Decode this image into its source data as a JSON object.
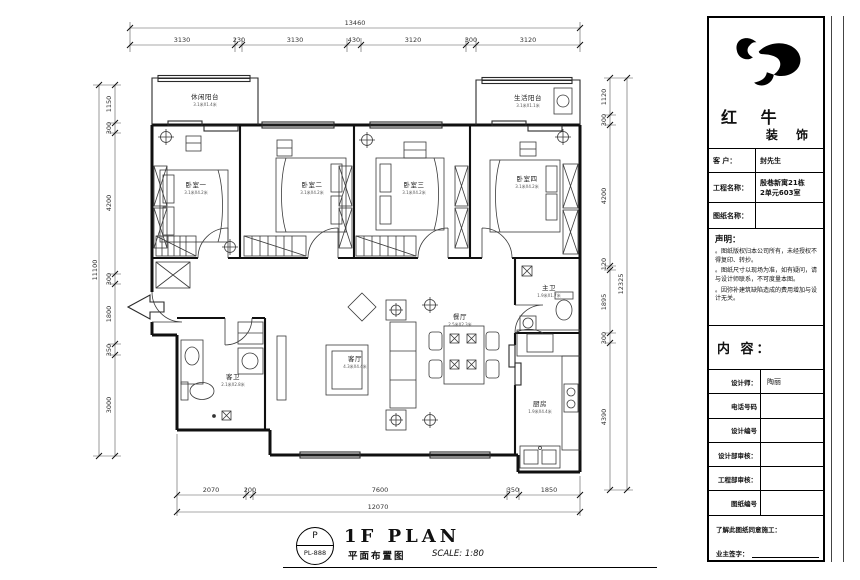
{
  "title_block": {
    "company_name_top": "红 牛",
    "company_name_bottom": "装 饰",
    "client_label": "客 户：",
    "client_value": "封先生",
    "project_label": "工程名称：",
    "project_value_line1": "殷巷新寓21栋",
    "project_value_line2": "2单元603室",
    "drawing_name_label": "图纸名称：",
    "drawing_name_value": "",
    "statement_title": "声明：",
    "statement_notes": [
      "。图纸版权归本公司所有，未经授权不得复印、转抄。",
      "。图纸尺寸以现场为准，如有疑问，请与设计师联系，不可度量本图。",
      "。因弥补建筑缺陷造成的费用增加与设计无关。"
    ],
    "content_label": "内 容：",
    "info_rows": [
      {
        "label": "设计师：",
        "value": "陶丽"
      },
      {
        "label": "电话号码",
        "value": ""
      },
      {
        "label": "设计编号",
        "value": ""
      },
      {
        "label": "设计部审核：",
        "value": ""
      },
      {
        "label": "工程部审核：",
        "value": ""
      },
      {
        "label": "图纸编号",
        "value": ""
      }
    ],
    "acknowledge_label": "了解此图纸同意施工：",
    "owner_sign_label": "业主签字："
  },
  "plan": {
    "rooms": {
      "leisure_balcony": {
        "name": "休闲阳台",
        "size": "3.1米X1.4米"
      },
      "bedroom1": {
        "name": "卧室一",
        "size": "3.1米X4.2米"
      },
      "bedroom2": {
        "name": "卧室二",
        "size": "3.1米X4.2米"
      },
      "bedroom3": {
        "name": "卧室三",
        "size": "3.1米X4.2米"
      },
      "bedroom4": {
        "name": "卧室四",
        "size": "3.1米X4.2米"
      },
      "life_balcony": {
        "name": "生活阳台",
        "size": "3.1米X1.1米"
      },
      "guest_bath": {
        "name": "客卫",
        "size": "2.1米X2.8米"
      },
      "living": {
        "name": "客厅",
        "size": "4.3米X4.4米"
      },
      "dining": {
        "name": "餐厅",
        "size": "2.5米X2.3米"
      },
      "master_bath": {
        "name": "主卫",
        "size": "1.9米X1.7米"
      },
      "kitchen": {
        "name": "厨房",
        "size": "1.9米X4.4米"
      }
    }
  },
  "dims": {
    "top": {
      "total": "13460",
      "segments": [
        "3130",
        "230",
        "3130",
        "430",
        "3120",
        "300",
        "3120"
      ]
    },
    "left": {
      "total": "11100",
      "segments": [
        "1150",
        "300",
        "4200",
        "300",
        "1800",
        "350",
        "3000"
      ]
    },
    "right": {
      "total": "12325",
      "segments": [
        "1120",
        "300",
        "4200",
        "120",
        "1895",
        "300",
        "4390"
      ]
    },
    "bottom": {
      "total": "12070",
      "segments": [
        "2070",
        "200",
        "7600",
        "350",
        "1850"
      ]
    }
  },
  "footer": {
    "stamp_letter": "P",
    "stamp_code": "PL-888",
    "plan_title": "1F PLAN",
    "plan_subtitle": "平面布置图",
    "scale_text": "SCALE: 1:80"
  }
}
